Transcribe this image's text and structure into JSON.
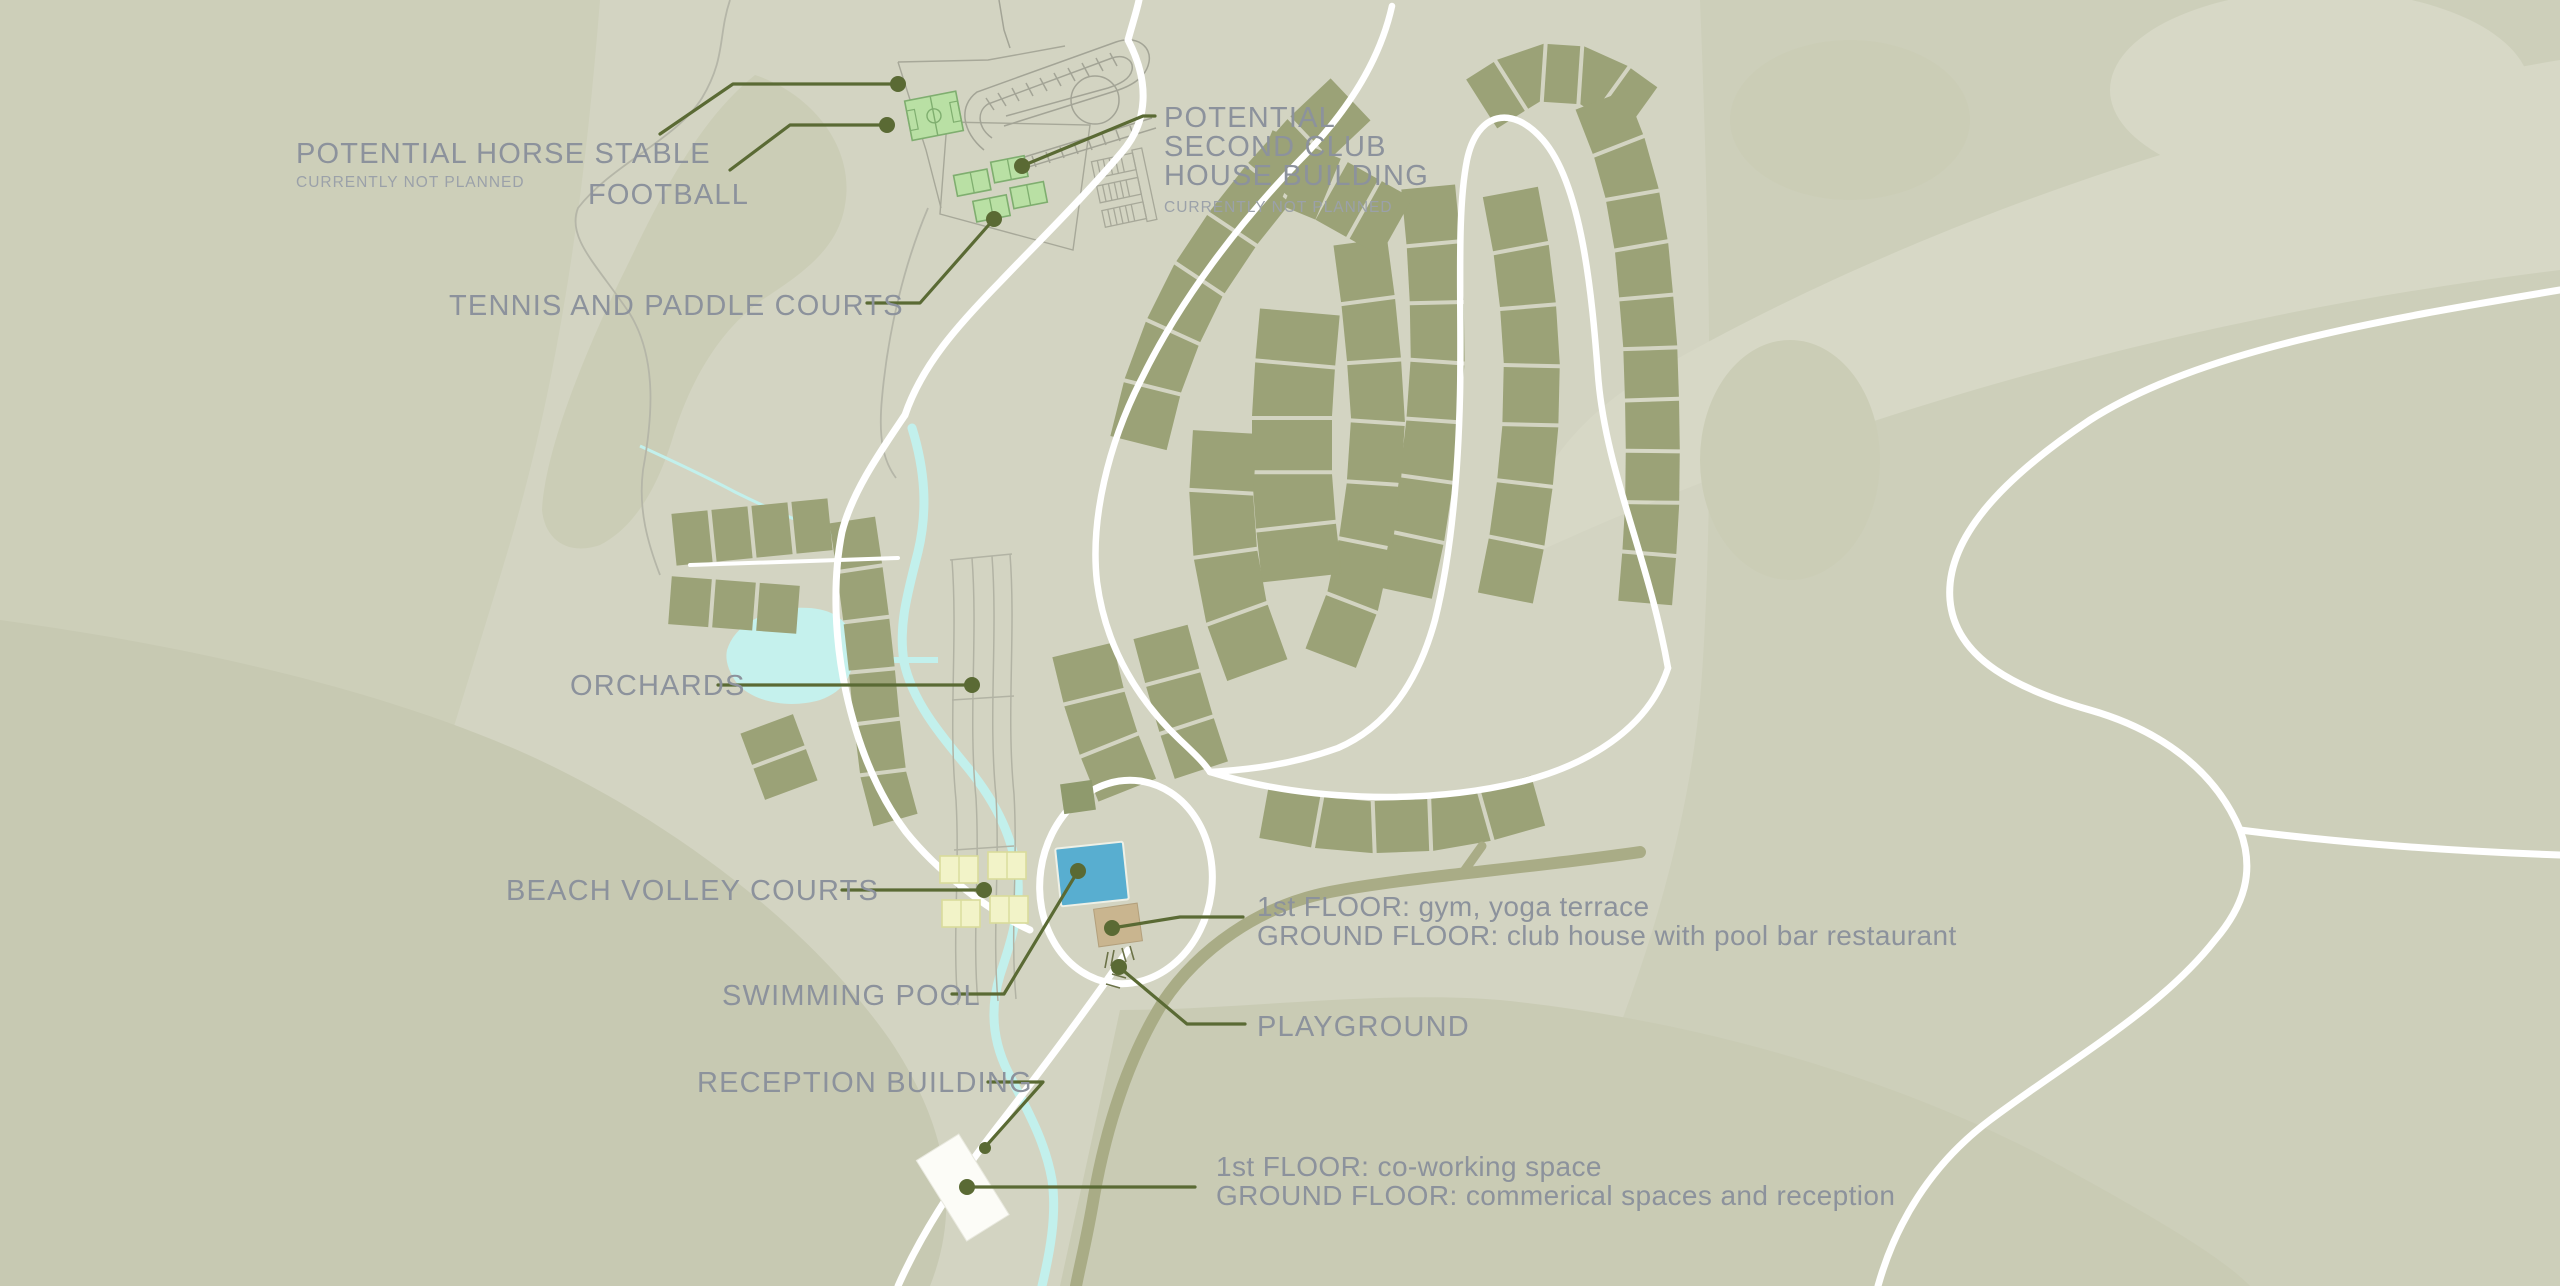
{
  "meta": {
    "title": "Resort site master plan map"
  },
  "colors": {
    "base": "#d5d6c4",
    "terrain_dark": "#cbcdb6",
    "terrain_darker": "#c7c9b2",
    "terrain_light": "#d8d9c7",
    "lot": "#9ba277",
    "road": "#ffffff",
    "water": "#c2f0ec",
    "pool": "#58aed0",
    "club_house_building": "#c9b58f",
    "reception_building": "#fcfcf7",
    "sport_green": "#b9e0a4",
    "sand_court": "#f2f3c8",
    "leader": "#5a6a34",
    "label_text": "#8c929c",
    "caption_text": "#9ba1a9"
  },
  "labels": {
    "horse_stable": {
      "text": "POTENTIAL HORSE STABLE",
      "caption": "CURRENTLY NOT PLANNED"
    },
    "football": {
      "text": "FOOTBALL"
    },
    "tennis": {
      "text": "TENNIS AND PADDLE COURTS"
    },
    "second_club": {
      "lines": [
        "POTENTIAL",
        "SECOND CLUB",
        "HOUSE BUILDING"
      ],
      "caption": "CURRENTLY NOT PLANNED"
    },
    "orchards": {
      "text": "ORCHARDS"
    },
    "beach_volley": {
      "text": "BEACH VOLLEY COURTS"
    },
    "swimming_pool": {
      "text": "SWIMMING POOL"
    },
    "reception": {
      "text": "RECEPTION BUILDING"
    },
    "playground": {
      "text": "PLAYGROUND"
    },
    "club_house_info": {
      "line1": "1st FLOOR: gym, yoga terrace",
      "line2": "GROUND FLOOR: club house with pool bar restaurant"
    },
    "reception_info": {
      "line1": "1st FLOOR: co-working space",
      "line2": "GROUND FLOOR: commerical spaces and reception"
    }
  },
  "features": [
    "horse-stable-track",
    "football-pitch",
    "tennis-paddle-courts",
    "second-club-house-outline",
    "housing-lots",
    "orchards-rows",
    "pond",
    "stream",
    "beach-volley-courts",
    "swimming-pool",
    "club-house-building",
    "playground",
    "reception-building",
    "roads"
  ]
}
